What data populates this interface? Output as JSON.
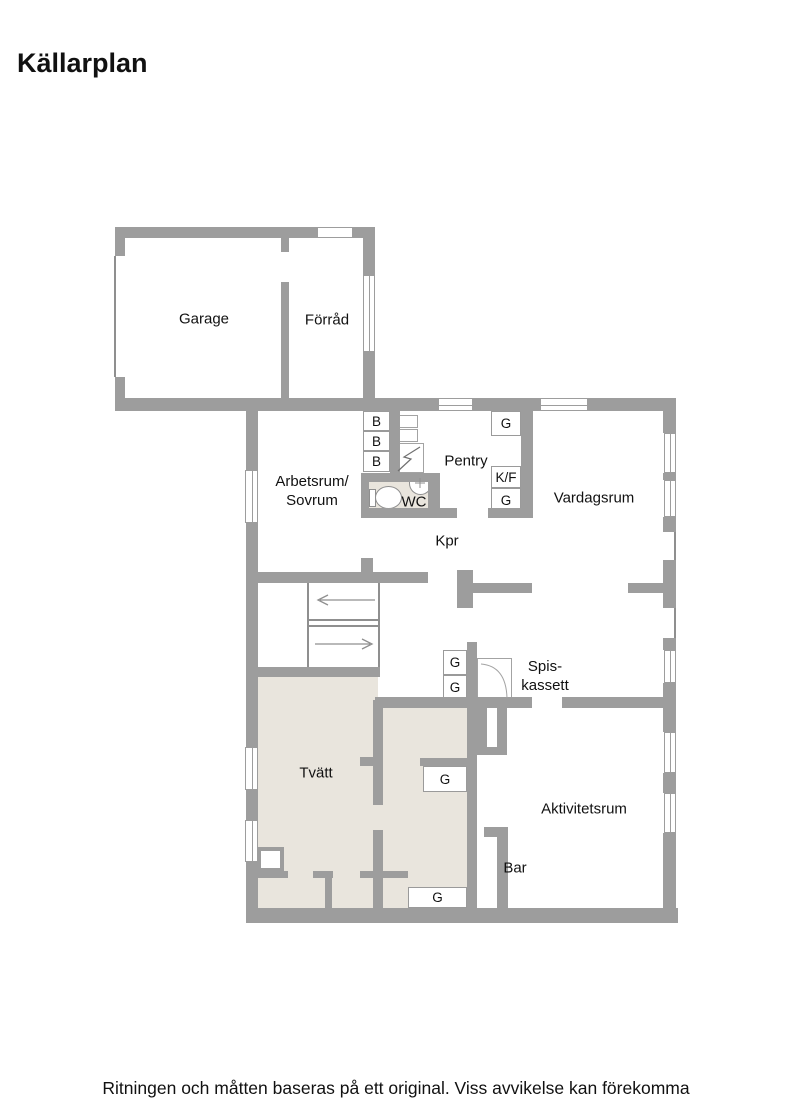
{
  "page": {
    "title": "Källarplan",
    "disclaimer": "Ritningen och måtten baseras på ett original. Viss avvikelse kan förekomma"
  },
  "rooms": {
    "garage": "Garage",
    "forrad": "Förråd",
    "arbetsrum_line1": "Arbetsrum/",
    "arbetsrum_line2": "Sovrum",
    "pentry": "Pentry",
    "wc": "WC",
    "kpr": "Kpr",
    "vardagsrum": "Vardagsrum",
    "spiskassett_line1": "Spis-",
    "spiskassett_line2": "kassett",
    "tvatt": "Tvätt",
    "aktivitetsrum": "Aktivitetsrum",
    "bar": "Bar"
  },
  "fixtures": {
    "bench_label": "B",
    "cabinet_label": "G",
    "fridge_freezer_label": "K/F"
  },
  "colors": {
    "wall": "#9d9d9d",
    "thin_line": "#8f8f8f",
    "wet_floor": "#e9e5dd",
    "text": "#111111",
    "background": "#ffffff"
  }
}
